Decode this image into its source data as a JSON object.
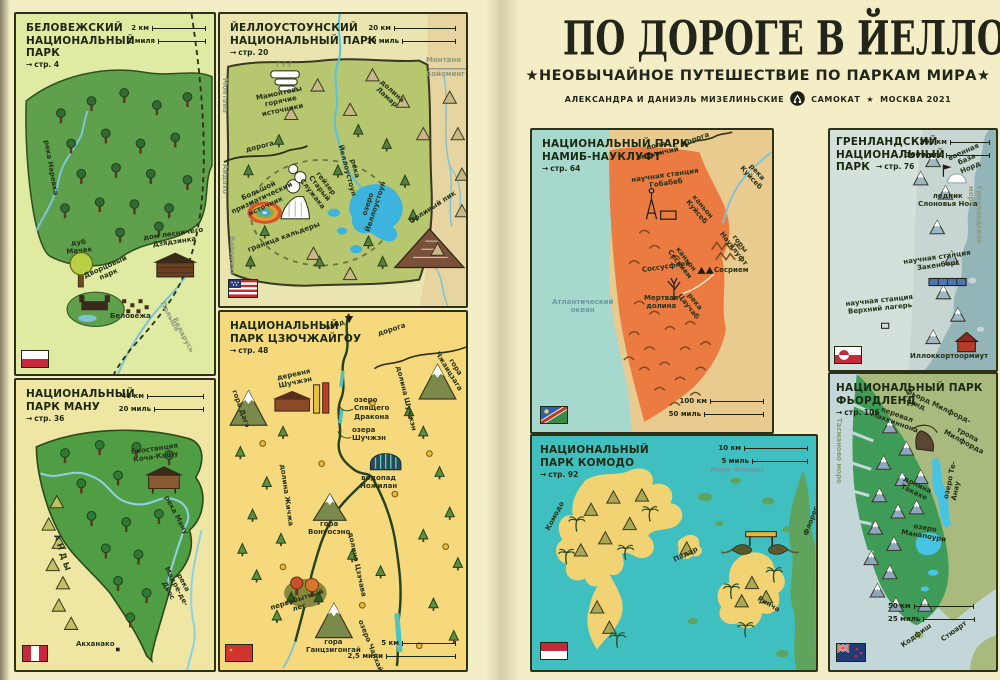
{
  "icons": {
    "page_arrow": "→"
  },
  "colors": {
    "page_background": "#f4eec6",
    "ink": "#23291a",
    "park_green": "#5ea04b",
    "yellowstone_park": "#b6c76f",
    "jiuzhaigou_bg": "#f6d97c",
    "namib_orange": "#ec7b42",
    "ocean_teal": "#a7d8cd",
    "komodo_sea": "#3fbfc0",
    "island_yellow": "#f2d373",
    "fiordland_green": "#3f9b58",
    "lake_blue": "#3db4dd"
  },
  "book": {
    "title": "ПО ДОРОГЕ В ЙЕЛЛОУСТОУН",
    "subtitle": "★НЕОБЫЧАЙНОЕ ПУТЕШЕСТВИЕ ПО ПАРКАМ МИРА★",
    "authors": "АЛЕКСАНДРА И ДАНИЭЛЬ МИЗЕЛИНЬСКИЕ",
    "publisher": "САМОКАТ",
    "separator_star": "★",
    "city_year": "МОСКВА 2021"
  },
  "panels": {
    "belovezhsky": {
      "title": "БЕЛОВЕЖСКИЙ\nНАЦИОНАЛЬНЫЙ\nПАРК",
      "page_ref": "стр. 4",
      "scale_km": "2 км",
      "scale_mi": "1 миля",
      "labels": {
        "river": "река Наревка",
        "oak": "дуб\nМачек",
        "forester_house": "дом лесничего\nДзядзинка",
        "palace_park": "Дворцовый\nпарк",
        "village": "Беловежа",
        "poland": "Польша",
        "belarus": "Беларусь"
      },
      "flag": "poland-flag"
    },
    "yellowstone": {
      "title": "ЙЕЛЛОУСТОУНСКИЙ\nНАЦИОНАЛЬНЫЙ ПАРК",
      "page_ref": "стр. 20",
      "scale_km": "20 км",
      "scale_mi": "10 миль",
      "labels": {
        "road": "дорога",
        "mammoth": "Мамонтовы\nгорячие\nисточники",
        "lamar_valley": "долина\nЛамар",
        "montana": "Монтана",
        "wyoming": "Вайоминг",
        "idaho": "Айдахо",
        "geyser": "гейзер\nСтарый\nСлужака",
        "prismatic": "Большой\nпризматический\nисточник",
        "caldera": "граница кальдеры",
        "lake": "озеро\nЙеллоустоун",
        "river": "река\nЙеллоустоун",
        "eagle_peak": "Орлиный пик"
      },
      "flag": "usa-flag"
    },
    "manu": {
      "title": "НАЦИОНАЛЬНЫЙ\nПАРК МАНУ",
      "page_ref": "стр. 36",
      "scale_km": "40 км",
      "scale_mi": "20 миль",
      "labels": {
        "station": "биостанция\nКоча-Кашу",
        "manu_river": "река Ману",
        "andes": "АНДЫ",
        "madre_river": "река\nМадре-де-Дьос",
        "town": "Акханако"
      },
      "flag": "peru-flag"
    },
    "jiuzhaigou": {
      "title": "НАЦИОНАЛЬНЫЙ\nПАРК ЦЗЮЧЖАЙГОУ",
      "page_ref": "стр. 48",
      "scale_km": "5 км",
      "scale_mi": "2,5 мили",
      "labels": {
        "entrance": "вход",
        "road": "дорога",
        "zhayizhaga": "гора\nЧжаицзага",
        "village": "деревня\nШучжэн",
        "shuzheng_valley": "долина Шучжэн",
        "dage": "гора Дагэ",
        "dragon_lake": "озеро\nСпящего\nДракона",
        "shuzheng_lakes": "озера\nШучжэн",
        "waterfall": "водопад\nНожилан",
        "rize_valley": "долина Жичжа",
        "wonuo": "гора\nВонуосэно",
        "zechawa_valley": "долина Цзэчава",
        "forest": "первобытный\nлес",
        "ganzi": "гора\nГанцзигонгай",
        "long_lake": "озеро Чанхай"
      },
      "flag": "china-flag"
    },
    "namib": {
      "title": "НАЦИОНАЛЬНЫЙ ПАРК\nНАМИБ-НАУКЛУФТ",
      "page_ref": "стр. 64",
      "scale_km": "100 км",
      "scale_mi": "50 миль",
      "labels": {
        "welwitschia": "поля\nвельвичий",
        "road": "дорога",
        "kuiseb_river": "река\nКуйсеб",
        "gobabeb": "научная станция\nГобабеб",
        "kuiseb_canyon": "каньон\nКуйсеб",
        "naukluft": "горы\nНауклуфт",
        "sesriem_canyon": "каньон\nСесрием",
        "sesriem": "Сесрием",
        "sossusvlei": "Соссусфлей",
        "tsauchab": "река\nЦаучаб",
        "deadvlei": "Мертвая\nдолина",
        "ocean": "Атлантический\nокеан"
      },
      "flag": "namibia-flag"
    },
    "greenland": {
      "title": "ГРЕНЛАНДСКИЙ\nНАЦИОНАЛЬНЫЙ\nПАРК",
      "page_ref": "стр. 76",
      "scale_km": "200 км",
      "scale_mi": "100 миль",
      "labels": {
        "nord_base": "военная\nбаза\nНорд",
        "glacier": "ледник\nСлоновья Нога",
        "sea": "Гренландское море",
        "zackenberg": "научная станция\nЗакенберг",
        "upper_camp": "научная станция\nВерхний лагерь",
        "town": "Иллоккортоормиут"
      },
      "flag": "greenland-flag"
    },
    "komodo": {
      "title": "НАЦИОНАЛЬНЫЙ\nПАРК КОМОДО",
      "page_ref": "стр. 92",
      "scale_km": "10 км",
      "scale_mi": "5 миль",
      "labels": {
        "flores_sea": "Море Флорес",
        "komodo_island": "Комодо",
        "padar": "Падар",
        "rinca": "Ринча",
        "flores": "Флорес"
      },
      "flag": "indonesia-flag"
    },
    "fiordland": {
      "title": "НАЦИОНАЛЬНЫЙ ПАРК\nФЬОРДЛЕНД",
      "page_ref": "стр. 106",
      "scale_km": "50 км",
      "scale_mi": "25 миль",
      "labels": {
        "milford_sound": "фьорд Милфорд-Саунд",
        "mackinnon_pass": "перевал\nМаккиннона",
        "milford_track": "тропа\nМилфорда",
        "te_anau": "озеро Те-Анау",
        "takahe_valley": "долина\nТакахе",
        "manapouri": "озеро\nМанапоури",
        "tasman_sea": "Тасманово море",
        "codfish": "Кодфиш",
        "stewart": "Стюарт"
      },
      "flag": "new-zealand-flag"
    }
  }
}
